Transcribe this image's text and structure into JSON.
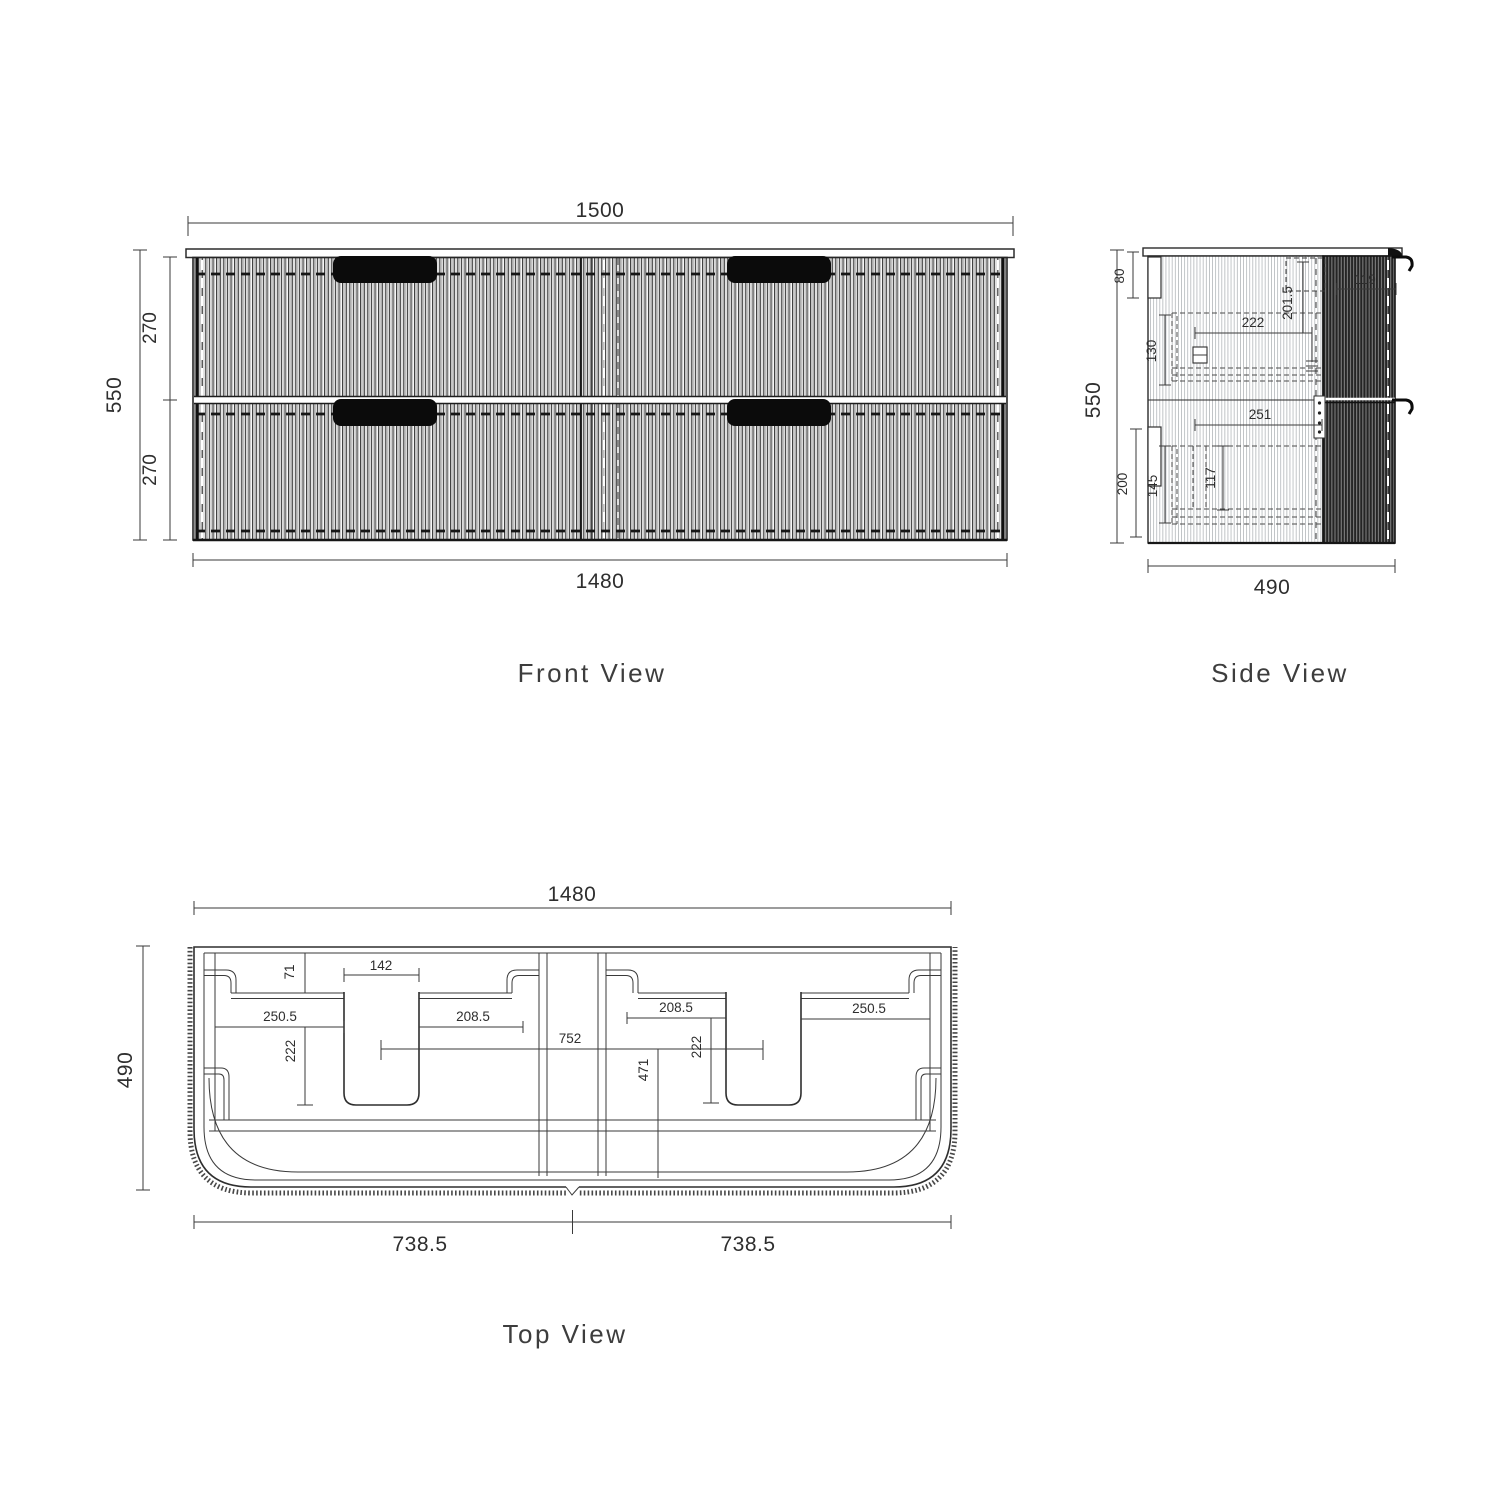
{
  "front_view": {
    "label": "Front View",
    "dims": {
      "overall_width": "1500",
      "cabinet_width": "1480",
      "overall_height": "550",
      "top_drawer_height": "270",
      "bottom_drawer_height": "270"
    }
  },
  "side_view": {
    "label": "Side View",
    "dims": {
      "overall_height": "550",
      "overall_depth": "490",
      "top_rail": "80",
      "drawer1_back_height": "130",
      "drawer1_depth": "222",
      "benchtop_drop": "201.5",
      "front_edge": "119",
      "drawer2_depth": "251",
      "bottom_rail": "200",
      "drawer2_back_height": "145",
      "drawer2_inner_height": "117"
    }
  },
  "top_view": {
    "label": "Top View",
    "dims": {
      "cabinet_width": "1480",
      "cabinet_depth": "490",
      "half_width_left": "738.5",
      "half_width_right": "738.5",
      "back_offset": "71",
      "waste_cutout_width": "142",
      "left_outer_span": "250.5",
      "left_inner_span": "208.5",
      "left_cutout_depth": "222",
      "basin_centres": "752",
      "inner_depth": "471",
      "right_inner_span": "208.5",
      "right_cutout_depth": "222",
      "right_outer_span": "250.5"
    }
  }
}
